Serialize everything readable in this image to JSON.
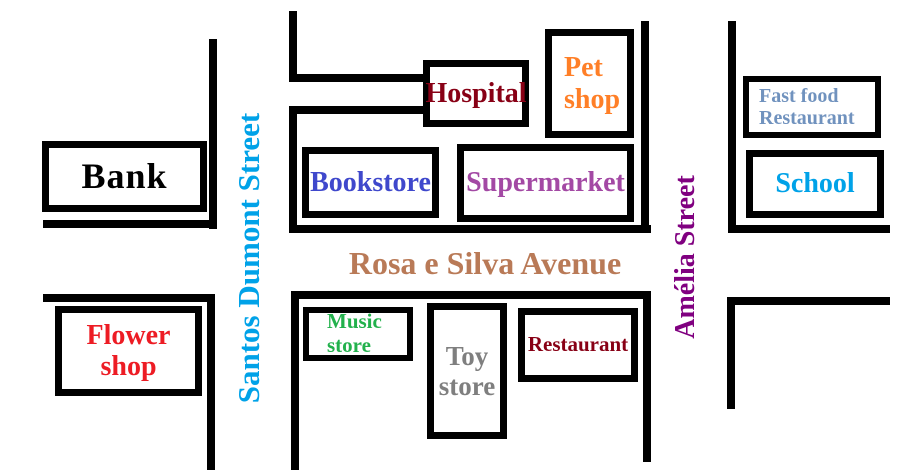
{
  "canvas": {
    "background": "#FFFFFF",
    "street_line_color": "#000000"
  },
  "streets": {
    "santos_dumont": {
      "label": "Santos Dumont Street",
      "color": "#00A2E8",
      "orientation": "vertical"
    },
    "rosa_e_silva": {
      "label": "Rosa e Silva Avenue",
      "color": "#B97A57",
      "orientation": "horizontal"
    },
    "amelia": {
      "label": "Amélia Street",
      "color": "#800080",
      "orientation": "vertical"
    }
  },
  "places": {
    "bank": {
      "label": "Bank",
      "color": "#000000"
    },
    "hospital": {
      "label": "Hospital",
      "color": "#880015"
    },
    "pet_shop": {
      "label": "Pet shop",
      "color": "#FF7F27"
    },
    "bookstore": {
      "label": "Bookstore",
      "color": "#3F48CC"
    },
    "supermarket": {
      "label": "Supermarket",
      "color": "#A349A4"
    },
    "fast_food_restaurant": {
      "label": "Fast food Restaurant",
      "color": "#7092BE"
    },
    "school": {
      "label": "School",
      "color": "#00A2E8"
    },
    "flower_shop": {
      "label": "Flower shop",
      "color": "#ED1C24"
    },
    "music_store": {
      "label": "Music store",
      "color": "#22B14C"
    },
    "toy_store": {
      "label": "Toy store",
      "color": "#7F7F7F"
    },
    "restaurant": {
      "label": "Restaurant",
      "color": "#880015"
    }
  }
}
